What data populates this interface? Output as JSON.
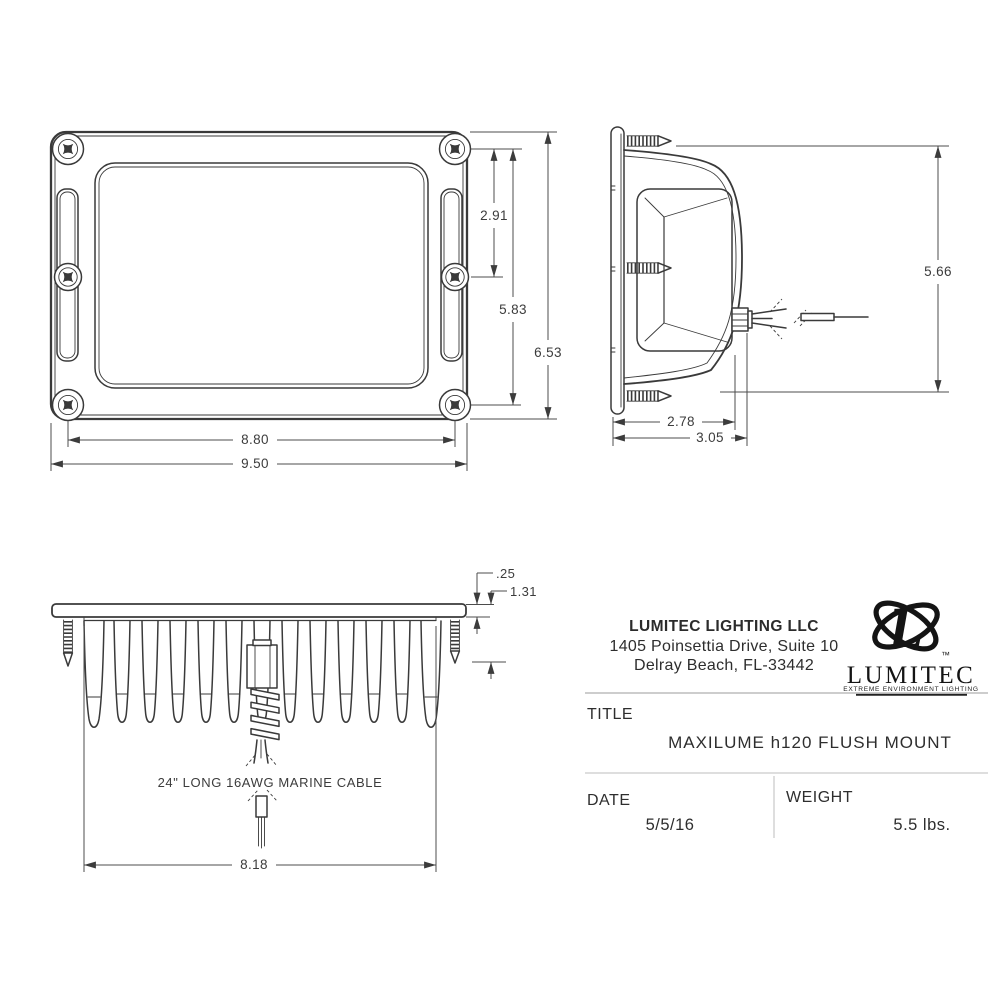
{
  "front_view": {
    "dims": {
      "upper_screw_spacing": "2.91",
      "vertical_screw_span": "5.83",
      "overall_height": "6.53",
      "horizontal_screw_span": "8.80",
      "overall_width": "9.50"
    }
  },
  "side_view": {
    "dims": {
      "overall_height": "5.66",
      "body_depth": "2.78",
      "overall_depth": "3.05"
    }
  },
  "bottom_view": {
    "dims": {
      "flange_thickness": ".25",
      "flange_offset": "1.31",
      "fin_span": "8.18"
    },
    "cable_note": "24\" LONG 16AWG MARINE CABLE"
  },
  "title_block": {
    "company_name": "LUMITEC LIGHTING LLC",
    "address_line_1": "1405 Poinsettia Drive, Suite 10",
    "address_line_2": "Delray Beach, FL-33442",
    "logo": {
      "monogram": "L",
      "trademark": "™",
      "wordmark": "LUMITEC",
      "tagline": "EXTREME ENVIRONMENT LIGHTING"
    },
    "title_label": "TITLE",
    "title_value": "MAXILUME h120 FLUSH MOUNT",
    "date_label": "DATE",
    "date_value": "5/5/16",
    "weight_label": "WEIGHT",
    "weight_value": "5.5 lbs."
  },
  "colors": {
    "ink": "#3a3a3a",
    "background": "#ffffff",
    "light_line": "#bcbcbc"
  }
}
